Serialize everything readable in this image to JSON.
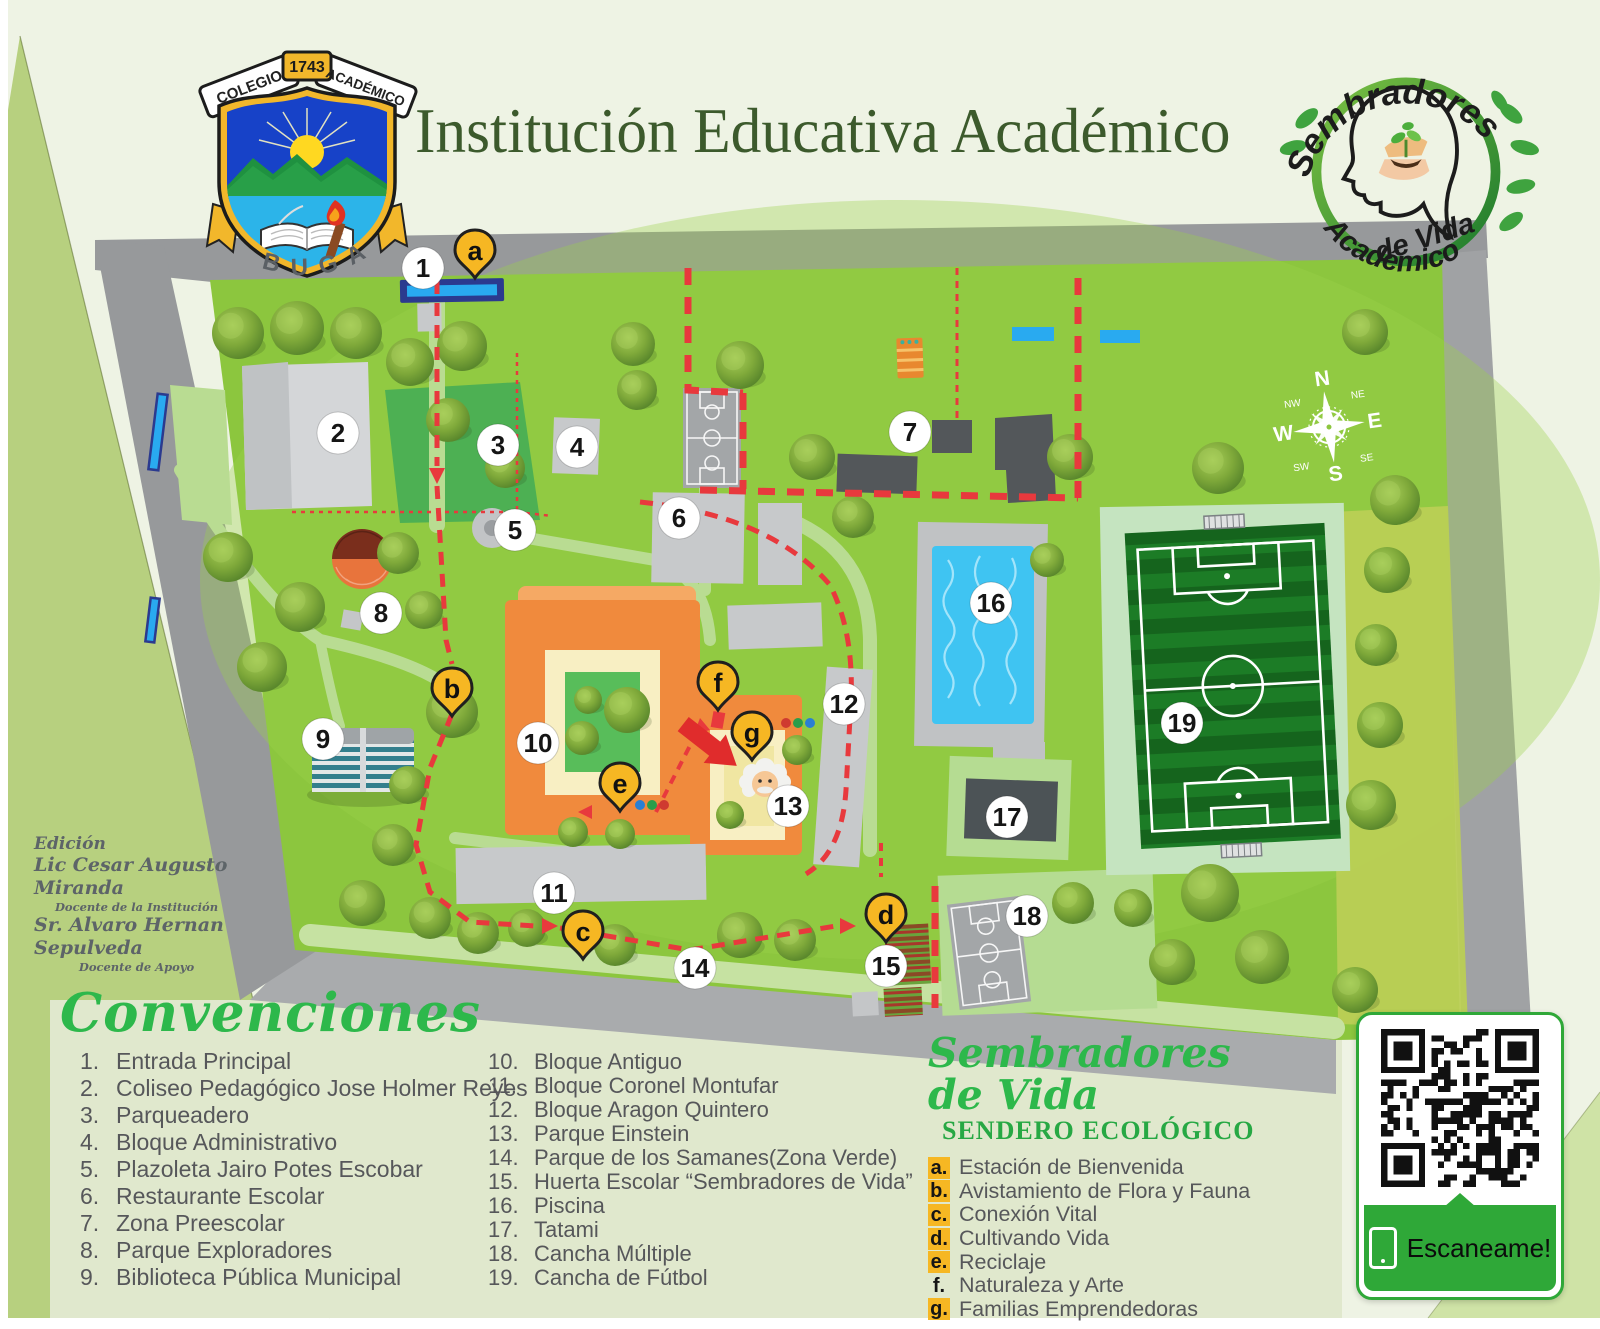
{
  "page": {
    "background": "#eef3e4"
  },
  "header": {
    "title": "Institución Educativa Académico",
    "crest": {
      "ribbon_left": "COLEGIO",
      "ribbon_year": "1743",
      "ribbon_right": "ACADÉMICO",
      "city": "BUGA"
    },
    "seal": {
      "arc_top": "Sembradores",
      "center": "de Vida",
      "arc_bottom": "Académico"
    }
  },
  "edition": {
    "heading": "Edición",
    "lines": [
      "Lic Cesar Augusto Miranda",
      "Docente de la Institución",
      "Sr. Alvaro Hernan Sepulveda",
      "Docente de Apoyo"
    ]
  },
  "legend": {
    "title": "Convenciones",
    "column1": [
      {
        "n": "1.",
        "label": "Entrada Principal"
      },
      {
        "n": "2.",
        "label": "Coliseo Pedagógico Jose Holmer Reyes"
      },
      {
        "n": "3.",
        "label": "Parqueadero"
      },
      {
        "n": "4.",
        "label": "Bloque Administrativo"
      },
      {
        "n": "5.",
        "label": "Plazoleta Jairo Potes Escobar"
      },
      {
        "n": "6.",
        "label": "Restaurante Escolar"
      },
      {
        "n": "7.",
        "label": "Zona Preescolar"
      },
      {
        "n": "8.",
        "label": "Parque Exploradores"
      },
      {
        "n": "9.",
        "label": "Biblioteca Pública Municipal"
      }
    ],
    "column2": [
      {
        "n": "10.",
        "label": "Bloque Antiguo"
      },
      {
        "n": "11.",
        "label": "Bloque Coronel Montufar"
      },
      {
        "n": "12.",
        "label": "Bloque Aragon Quintero"
      },
      {
        "n": "13.",
        "label": "Parque Einstein"
      },
      {
        "n": "14.",
        "label": "Parque de los Samanes(Zona Verde)"
      },
      {
        "n": "15.",
        "label": "Huerta Escolar “Sembradores de Vida”"
      },
      {
        "n": "16.",
        "label": "Piscina"
      },
      {
        "n": "17.",
        "label": "Tatami"
      },
      {
        "n": "18.",
        "label": "Cancha Múltiple"
      },
      {
        "n": "19.",
        "label": "Cancha de Fútbol"
      }
    ]
  },
  "sendero": {
    "title": "Sembradores de Vida",
    "subtitle": "SENDERO ECOLÓGICO",
    "items": [
      {
        "k": "a.",
        "label": "Estación de Bienvenida",
        "highlight": true
      },
      {
        "k": "b.",
        "label": "Avistamiento de Flora y Fauna",
        "highlight": true
      },
      {
        "k": "c.",
        "label": "Conexión Vital",
        "highlight": true
      },
      {
        "k": "d.",
        "label": "Cultivando Vida",
        "highlight": true
      },
      {
        "k": "e.",
        "label": "Reciclaje",
        "highlight": true
      },
      {
        "k": "f.",
        "label": "Naturaleza y Arte",
        "highlight": false
      },
      {
        "k": "g.",
        "label": "Familias Emprendedoras",
        "highlight": true
      }
    ]
  },
  "qr": {
    "label": "Escaneame!"
  },
  "map": {
    "numbered_markers": [
      {
        "n": "1",
        "x": 423,
        "y": 268
      },
      {
        "n": "2",
        "x": 338,
        "y": 433
      },
      {
        "n": "3",
        "x": 498,
        "y": 445
      },
      {
        "n": "4",
        "x": 577,
        "y": 447
      },
      {
        "n": "5",
        "x": 515,
        "y": 530
      },
      {
        "n": "6",
        "x": 679,
        "y": 518
      },
      {
        "n": "7",
        "x": 910,
        "y": 432
      },
      {
        "n": "8",
        "x": 381,
        "y": 613
      },
      {
        "n": "9",
        "x": 323,
        "y": 739
      },
      {
        "n": "10",
        "x": 538,
        "y": 743
      },
      {
        "n": "11",
        "x": 554,
        "y": 893
      },
      {
        "n": "12",
        "x": 844,
        "y": 704
      },
      {
        "n": "13",
        "x": 788,
        "y": 806
      },
      {
        "n": "14",
        "x": 695,
        "y": 968
      },
      {
        "n": "15",
        "x": 886,
        "y": 966
      },
      {
        "n": "16",
        "x": 991,
        "y": 603
      },
      {
        "n": "17",
        "x": 1007,
        "y": 817
      },
      {
        "n": "18",
        "x": 1027,
        "y": 916
      },
      {
        "n": "19",
        "x": 1182,
        "y": 723
      }
    ],
    "letter_pins": [
      {
        "k": "a",
        "x": 475,
        "y": 250
      },
      {
        "k": "b",
        "x": 452,
        "y": 688
      },
      {
        "k": "c",
        "x": 583,
        "y": 931
      },
      {
        "k": "d",
        "x": 886,
        "y": 914
      },
      {
        "k": "e",
        "x": 620,
        "y": 783
      },
      {
        "k": "f",
        "x": 718,
        "y": 682
      },
      {
        "k": "g",
        "x": 752,
        "y": 732
      }
    ],
    "compass": {
      "cardinals": [
        "N",
        "E",
        "S",
        "W"
      ],
      "intercardinals": [
        "NW",
        "NE",
        "SE",
        "SW"
      ]
    }
  },
  "colors": {
    "accent_green": "#2db84b",
    "path_red": "#e8393d",
    "pin_yellow": "#f6b723",
    "qr_green": "#2fa838"
  }
}
